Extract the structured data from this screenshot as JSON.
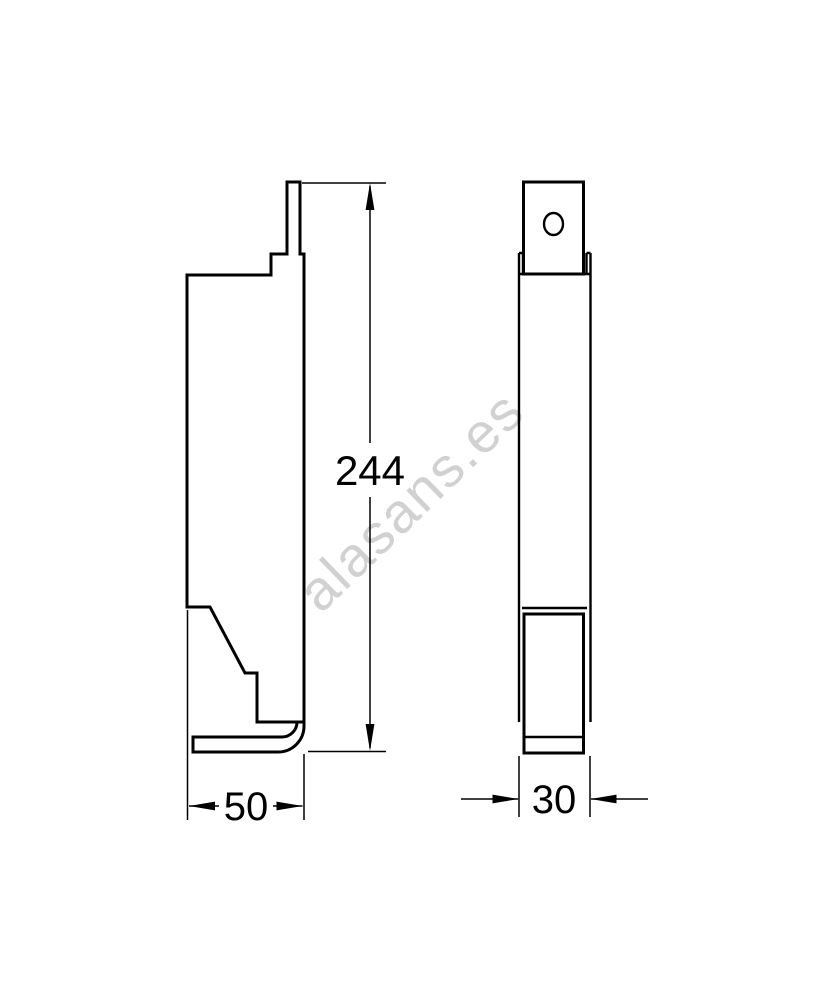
{
  "drawing": {
    "watermark": "alasans.es",
    "dimensions": {
      "height": "244",
      "front_width": "50",
      "side_width": "30"
    },
    "colors": {
      "line": "#000000",
      "watermark": "#c9c9c9",
      "background": "#ffffff"
    }
  }
}
